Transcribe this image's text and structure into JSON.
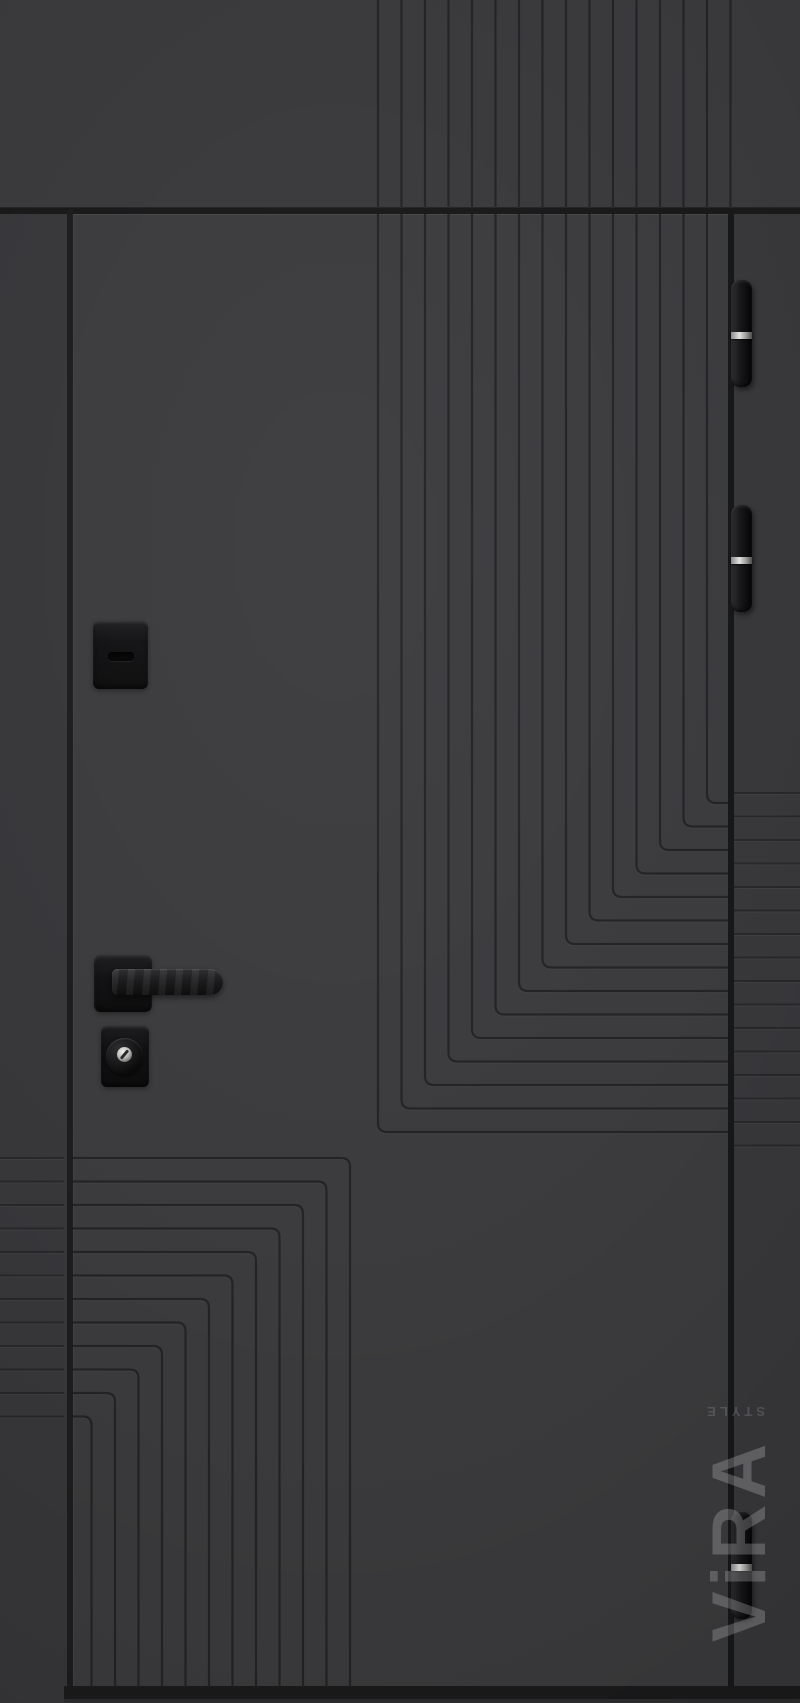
{
  "photo": {
    "subject": "black-entrance-door-product-photo",
    "orientation": "portrait"
  },
  "watermark": {
    "brand": "ViRA",
    "suffix": "STYLE"
  },
  "colors": {
    "wall": "#3a3a3c",
    "door_leaf": "#3c3c3e",
    "frame_strip": "#38383b",
    "seam": "#19191a",
    "gap": "#17181a",
    "groove_line": "#242427",
    "frame_groove_line": "#28282b",
    "hardware_black": "#0e0e0f",
    "hinge_ring_steel": "#e2e2e0",
    "key_cylinder_metal": "#f2f2f0",
    "watermark_gray": "rgba(205,205,210,0.30)",
    "bottom_shadow": "#1b1b1c"
  },
  "hardware": {
    "hinges": [
      {
        "name": "hinge-top",
        "y": 280
      },
      {
        "name": "hinge-middle",
        "y": 505
      },
      {
        "name": "hinge-bottom",
        "y": 1512
      }
    ],
    "items": [
      "night-lock-escutcheon",
      "lever-handle",
      "cylinder-lock"
    ]
  },
  "pattern": {
    "groove_spacing": 23.5,
    "corner_radius": 9,
    "transom_grooves": {
      "x_start": 378,
      "count": 16,
      "y0": 0,
      "y1": 207
    },
    "door_top_right": {
      "x_start": 378,
      "count": 15,
      "top_y": 214,
      "corner_y_at_first_x": 1132,
      "exit_x": 728
    },
    "door_bottom_left": {
      "corner_x_start": 350,
      "corner_y_start": 1158,
      "count": 12,
      "left_x": 73,
      "bottom_y": 1686
    },
    "left_frame_lines": {
      "y_start": 1158,
      "count": 12,
      "x0": 0,
      "x1": 64
    },
    "right_frame_lines": {
      "y_start": 793,
      "count": 16,
      "x0": 734,
      "x1": 800
    }
  }
}
